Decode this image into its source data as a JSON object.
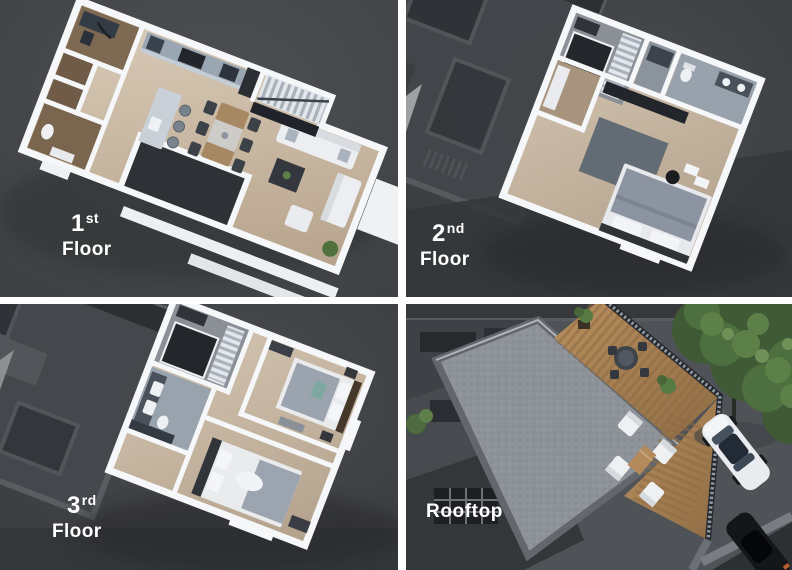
{
  "montage": {
    "panels": [
      {
        "name": "first-floor",
        "ordinal": "1",
        "ordinal_suffix": "st",
        "label": "Floor"
      },
      {
        "name": "second-floor",
        "ordinal": "2",
        "ordinal_suffix": "nd",
        "label": "Floor"
      },
      {
        "name": "third-floor",
        "ordinal": "3",
        "ordinal_suffix": "rd",
        "label": "Floor"
      },
      {
        "name": "rooftop",
        "label": "Rooftop"
      }
    ],
    "colors": {
      "panel_background": "#45474a",
      "divider_white": "#ffffff",
      "label_text": "#ffffff",
      "floor_wood": "#c9b7a2",
      "wall_white": "#f6f7f9",
      "roof_gray": "#8e939a",
      "deck_wood": "#b08a5e",
      "foliage_green": "#4e6f3f",
      "shadow_gray": "#2e3033"
    }
  }
}
